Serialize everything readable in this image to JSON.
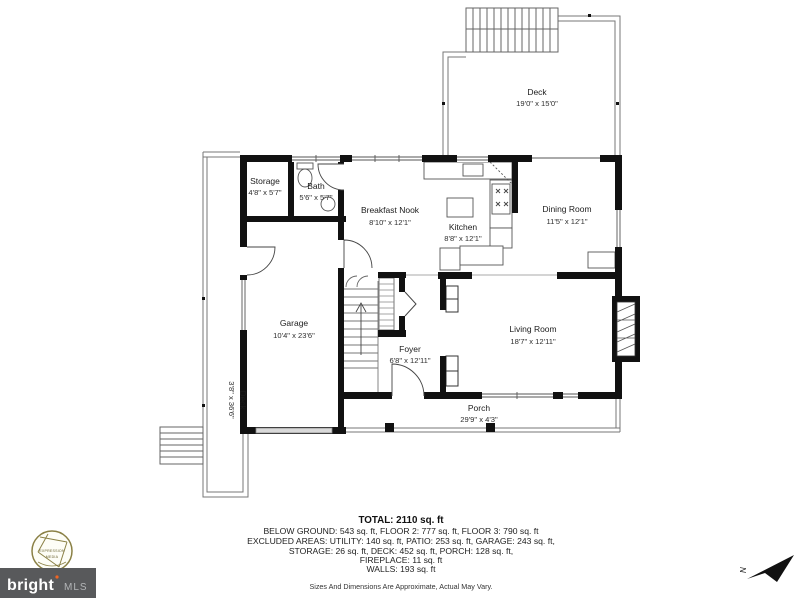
{
  "plan": {
    "wall_color": "#111111",
    "deck_line_color": "#777777",
    "fixture_line_color": "#555555",
    "rooms": [
      {
        "id": "deck-upper",
        "name": "Deck",
        "dims": "19'0\" x 15'0\""
      },
      {
        "id": "storage",
        "name": "Storage",
        "dims": "4'8\" x 5'7\""
      },
      {
        "id": "bath",
        "name": "Bath",
        "dims": "5'6\" x 5'7\""
      },
      {
        "id": "breakfast-nook",
        "name": "Breakfast Nook",
        "dims": "8'10\" x 12'1\""
      },
      {
        "id": "kitchen",
        "name": "Kitchen",
        "dims": "8'8\" x 12'1\""
      },
      {
        "id": "dining-room",
        "name": "Dining Room",
        "dims": "11'5\" x 12'1\""
      },
      {
        "id": "garage",
        "name": "Garage",
        "dims": "10'4\" x 23'6\""
      },
      {
        "id": "foyer",
        "name": "Foyer",
        "dims": "6'8\" x 12'11\""
      },
      {
        "id": "living-room",
        "name": "Living Room",
        "dims": "18'7\" x 12'11\""
      },
      {
        "id": "porch",
        "name": "Porch",
        "dims": "29'9\" x 4'3\""
      },
      {
        "id": "deck-side",
        "name": "Deck",
        "dims": "3'8\" x 36'6\""
      }
    ]
  },
  "summary": {
    "total": "TOTAL: 2110 sq. ft",
    "floors": "BELOW GROUND: 543 sq. ft, FLOOR 2: 777 sq. ft, FLOOR 3: 790 sq. ft",
    "excluded_line1": "EXCLUDED AREAS: UTILITY: 140 sq. ft, PATIO: 253 sq. ft, GARAGE: 243 sq. ft,",
    "excluded_line2": "STORAGE: 26 sq. ft, DECK: 452 sq. ft, PORCH: 128 sq. ft,",
    "fireplace": "FIREPLACE: 11 sq. ft",
    "walls": "WALLS: 193 sq. ft",
    "disclaimer": "Sizes And Dimensions Are Approximate, Actual May Vary."
  },
  "branding": {
    "mls_logo": {
      "text": "bright",
      "suffix": "MLS",
      "background": "#58595b",
      "accent": "#f26522"
    },
    "photographer_logo": {
      "line1": "EXPRESSION",
      "line2": "MEDIA",
      "color": "#8a8045"
    }
  },
  "compass": {
    "label": "N"
  }
}
